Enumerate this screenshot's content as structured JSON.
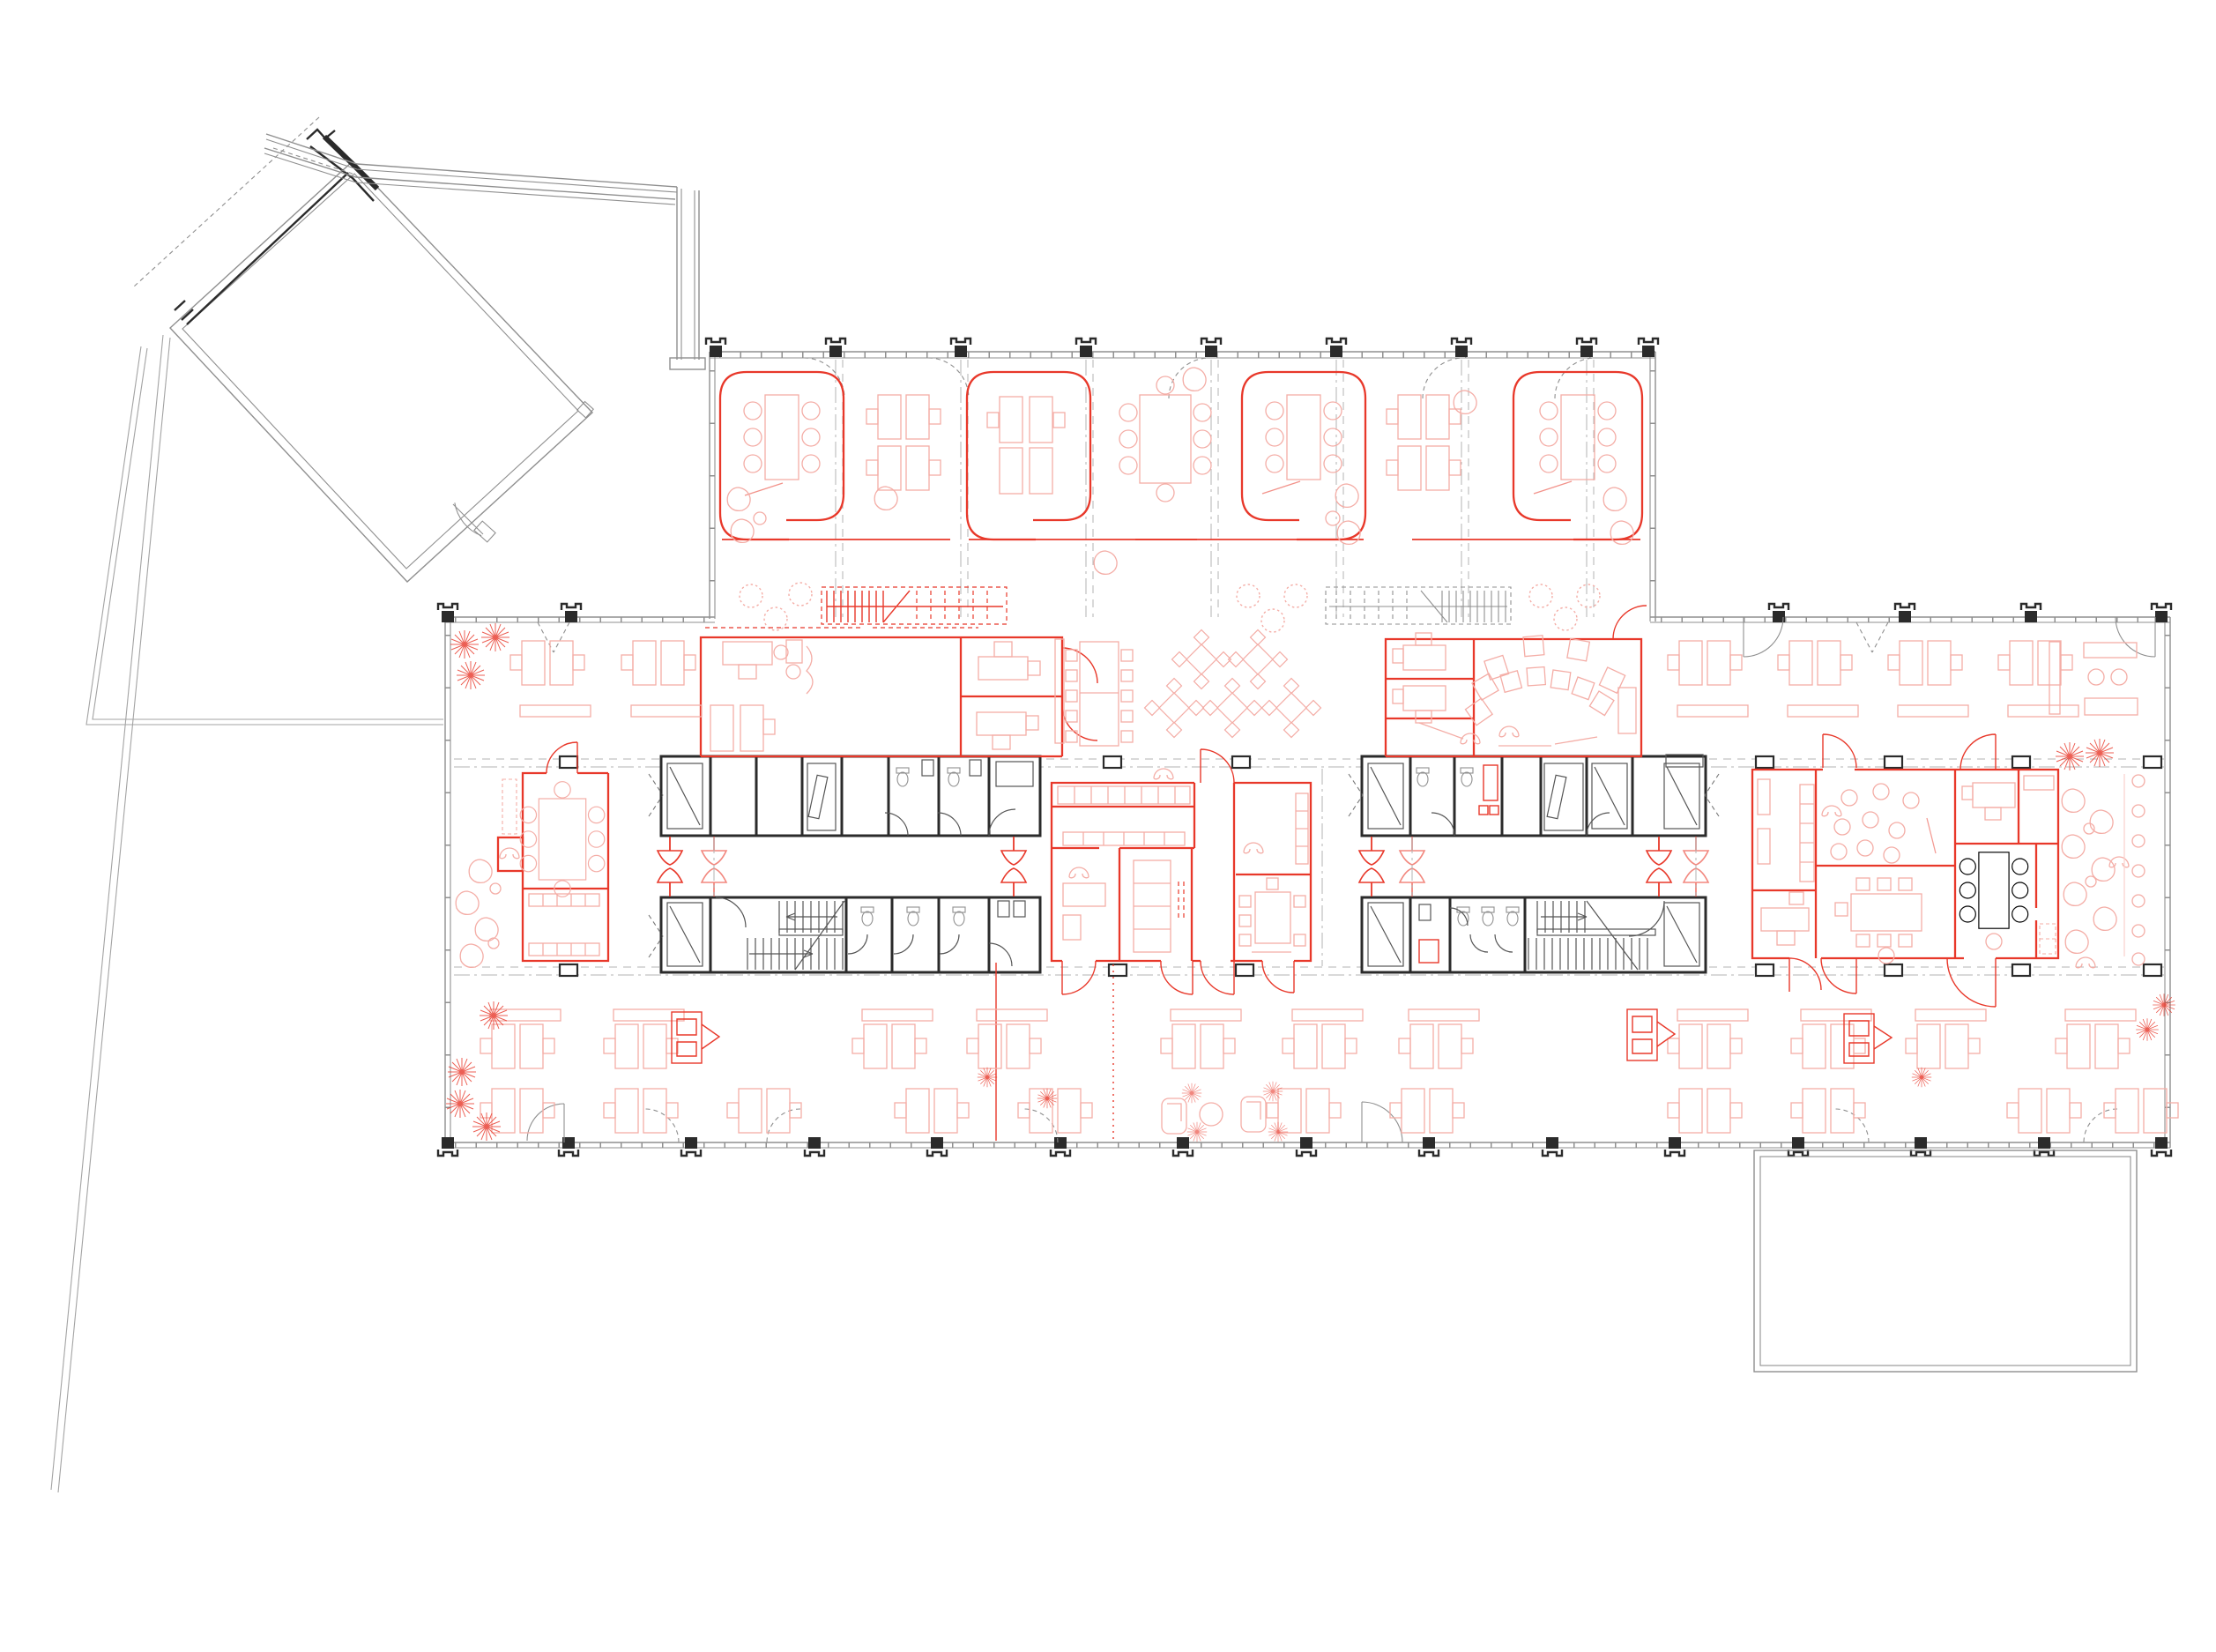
{
  "document": {
    "type": "architectural-floor-plan",
    "title": "office-building-floor-plan",
    "visible_text": "",
    "counts": {
      "wing_meeting_rooms": 4,
      "cores": 2,
      "red_room_clusters": 3,
      "terraces": 1,
      "annex_buildings": 1
    }
  },
  "colors": {
    "bg": "#ffffff",
    "red": "#e8382a",
    "redsoft": "#ef6a5e",
    "pink": "#f4ada6",
    "pinklight": "#f9d0cb",
    "gray": "#8f8f8f",
    "graylight": "#b3b3b3",
    "dark": "#2b2b2b",
    "site": "#a3a3a3"
  },
  "zones": {
    "annex": {
      "label": "annex-building"
    },
    "gallery": {
      "label": "gallery-link"
    },
    "wing": {
      "label": "north-meeting-wing",
      "rooms": [
        "meeting-room-1",
        "meeting-room-2",
        "meeting-room-3",
        "meeting-room-4"
      ]
    },
    "core_west": {
      "label": "core-west-stairs-wc-lift"
    },
    "core_east": {
      "label": "core-east-stairs-wc-lift"
    },
    "hub_center": {
      "label": "center-red-hub-focus-rooms"
    },
    "hub_east": {
      "label": "east-red-hub-meeting-workshop"
    },
    "meeting_west": {
      "label": "west-red-meeting-room"
    },
    "open_north_west": {
      "label": "open-office-north-west"
    },
    "open_north_east": {
      "label": "open-office-north-east"
    },
    "cafe": {
      "label": "cafe-tables-zone"
    },
    "open_south": {
      "label": "open-office-south"
    },
    "lounge_east": {
      "label": "lounge-east"
    },
    "terrace": {
      "label": "terrace-south-east"
    },
    "site": {
      "label": "site-boundary-lines"
    }
  }
}
